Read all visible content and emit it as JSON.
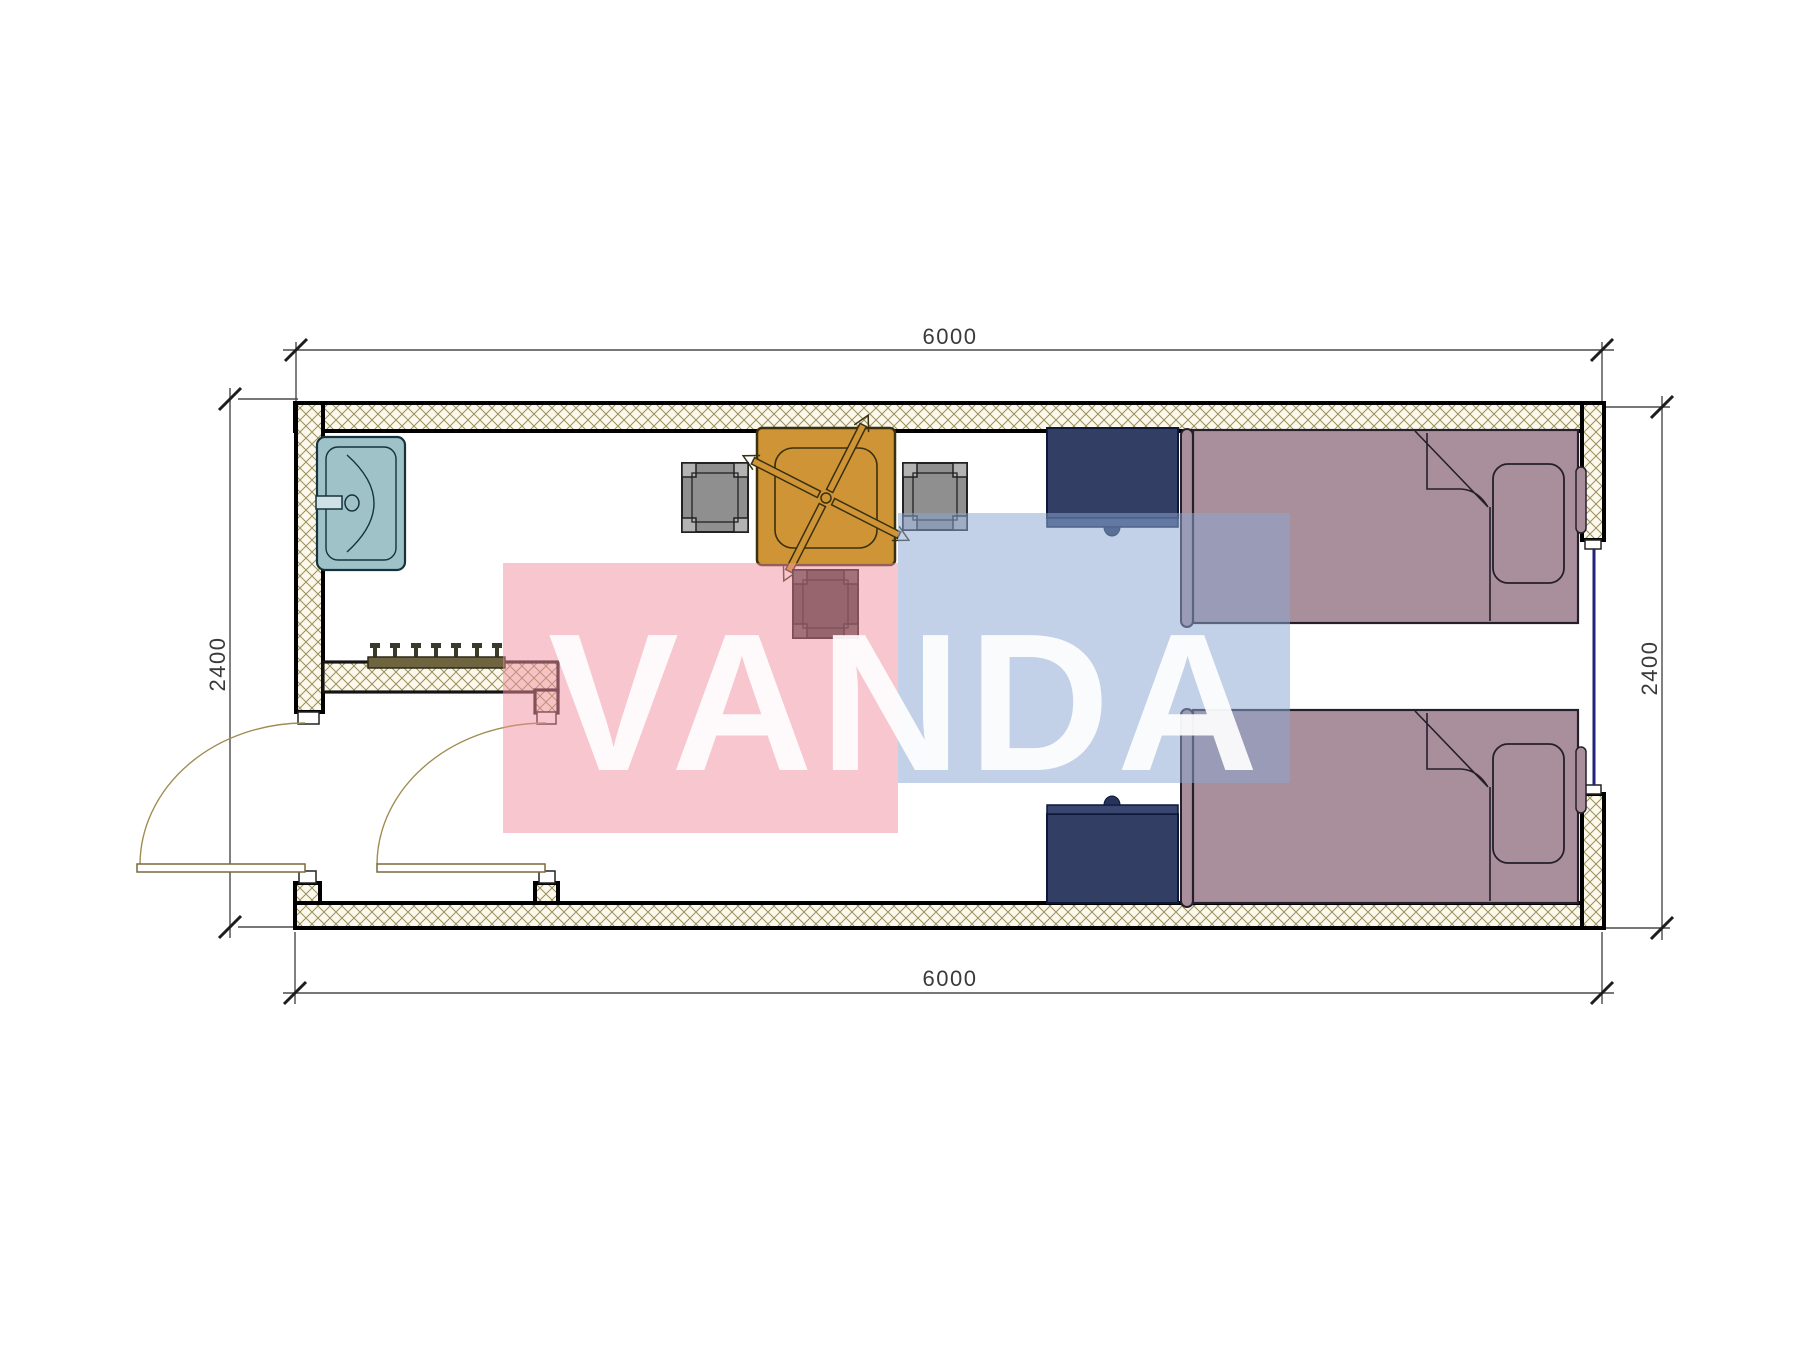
{
  "drawing": {
    "kind": "architectural floor plan (6m x 2.4m container room)",
    "background": "#ffffff",
    "dimensions": {
      "top_label": "6000",
      "bottom_label": "6000",
      "left_label": "2400",
      "right_label": "2400"
    },
    "watermark": {
      "text": "VANDA",
      "pink_color": "#EF8D9D",
      "blue_color": "#8BA7D1",
      "text_color": "#FFFFFF"
    },
    "walls": {
      "hatch_line_color": "#9a8f5c",
      "hatch_bg_color": "#fcf9ec",
      "outline_color": "#000000",
      "window_color": "#23237d"
    },
    "furniture": [
      {
        "name": "sink",
        "color": "#9fc2c9"
      },
      {
        "name": "square-dining-table-with-ceiling-fan-symbol",
        "color": "#cf9435"
      },
      {
        "name": "chair-left",
        "color": "#8f8f8f"
      },
      {
        "name": "chair-right",
        "color": "#8f8f8f"
      },
      {
        "name": "stool-below-table",
        "color": "#3d3d3d"
      },
      {
        "name": "nightstand-top",
        "color": "#323e64"
      },
      {
        "name": "nightstand-bottom",
        "color": "#323e64"
      },
      {
        "name": "bed-top-with-pillow-and-folded-blanket",
        "color": "#a98f9c"
      },
      {
        "name": "bed-bottom-with-pillow-and-folded-blanket",
        "color": "#a98f9c"
      },
      {
        "name": "coat-rack-with-7-hooks",
        "color": "#6e6440"
      },
      {
        "name": "entry-door-left-with-swing-arc",
        "color": "#a08c50"
      },
      {
        "name": "entry-door-right-with-swing-arc",
        "color": "#a08c50"
      },
      {
        "name": "window-right-wall",
        "color": "#23237d"
      }
    ]
  }
}
